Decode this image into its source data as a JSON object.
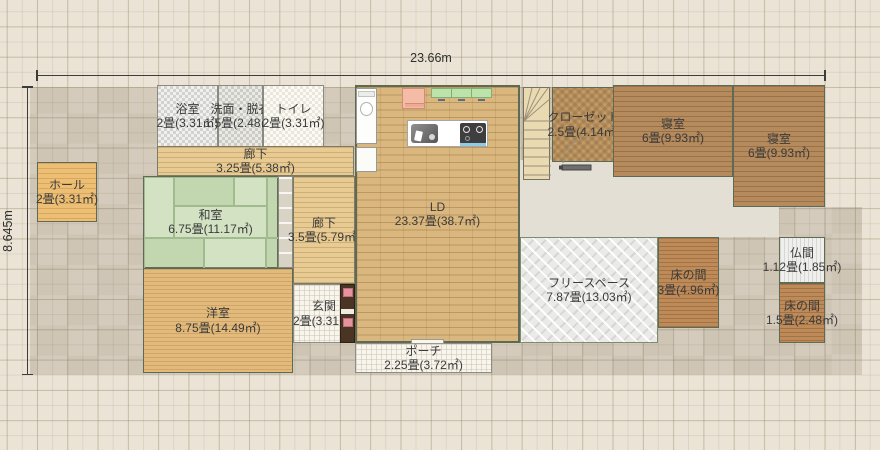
{
  "plan_title": "1F floor plan",
  "dims": {
    "width_label": "23.66m",
    "height_label": "8.645m"
  },
  "rooms": {
    "bath": {
      "name": "浴室",
      "size": "2畳(3.31㎡)"
    },
    "washroom": {
      "name": "洗面・脱衣",
      "size": "1.5畳(2.48㎡)"
    },
    "toilet": {
      "name": "トイレ",
      "size": "2畳(3.31㎡)"
    },
    "corridor1": {
      "name": "廊下",
      "size": "3.25畳(5.38㎡)"
    },
    "hall": {
      "name": "ホール",
      "size": "2畳(3.31㎡)"
    },
    "washitsu": {
      "name": "和室",
      "size": "6.75畳(11.17㎡)"
    },
    "corridor2": {
      "name": "廊下",
      "size": "3.5畳(5.79㎡)"
    },
    "ld": {
      "name": "LD",
      "size": "23.37畳(38.7㎡)"
    },
    "closet": {
      "name": "クローゼット",
      "size": "2.5畳(4.14㎡)"
    },
    "bedroom1": {
      "name": "寝室",
      "size": "6畳(9.93㎡)"
    },
    "bedroom2": {
      "name": "寝室",
      "size": "6畳(9.93㎡)"
    },
    "youshitsu": {
      "name": "洋室",
      "size": "8.75畳(14.49㎡)"
    },
    "genkan": {
      "name": "玄関",
      "size": "2畳(3.31㎡)"
    },
    "freespace": {
      "name": "フリースペース",
      "size": "7.87畳(13.03㎡)"
    },
    "tokonoma1": {
      "name": "床の間",
      "size": "3畳(4.96㎡)"
    },
    "butsuma": {
      "name": "仏間",
      "size": "1.12畳(1.85㎡)"
    },
    "tokonoma2": {
      "name": "床の間",
      "size": "1.5畳(2.48㎡)"
    },
    "porch": {
      "name": "ポーチ",
      "size": "2.25畳(3.72㎡)"
    }
  },
  "colors": {
    "background": "#ebe4d6",
    "site_shadow": "#d8d1c3",
    "tatami_green": "#cbdeb9",
    "ld_wood": "#d9b77e",
    "bedroom_wood": "#b58a5d",
    "corridor_wood": "#e8cb93",
    "freespace_gray": "#eaeae8",
    "wall_line": "#5f6a55"
  }
}
